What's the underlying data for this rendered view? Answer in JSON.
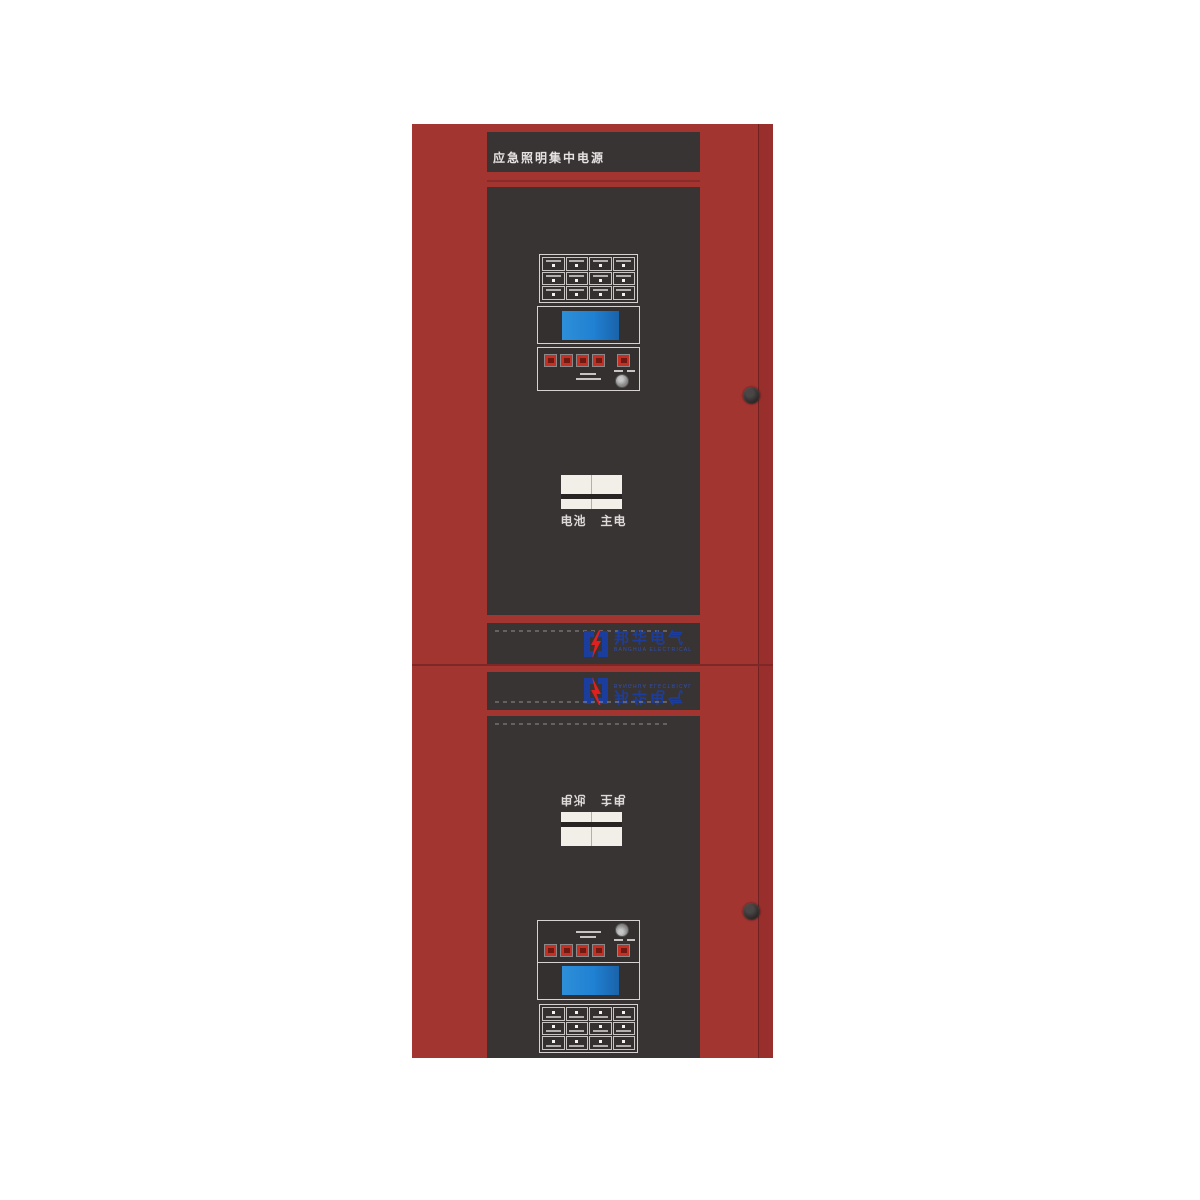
{
  "cabinet": {
    "title": "应急照明集中电源"
  },
  "units": {
    "upper": {
      "switch_labels": [
        "电池",
        "主电"
      ]
    },
    "lower": {
      "switch_labels": [
        "电池",
        "主电"
      ]
    }
  },
  "logo": {
    "name_cn": "邦华电气",
    "name_en": "BANGHUA ELECTRICAL"
  },
  "colors": {
    "body_red": "#a33531",
    "panel_dark": "#393434",
    "lcd_blue": "#2081d3",
    "button_red": "#c23026",
    "logo_blue": "#1b3e9e",
    "logo_red": "#e01f1f"
  }
}
